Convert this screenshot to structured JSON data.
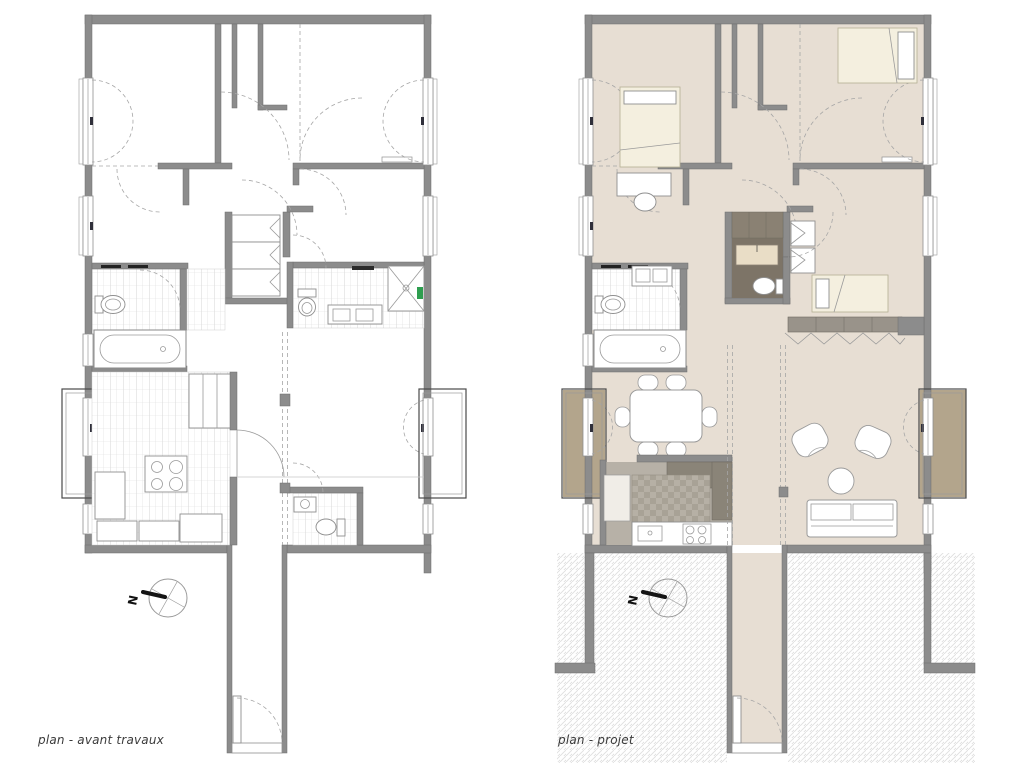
{
  "plans": [
    {
      "id": "avant-travaux",
      "label": "plan - avant travaux",
      "compass_label": "N"
    },
    {
      "id": "projet",
      "label": "plan - projet",
      "compass_label": "N"
    }
  ],
  "palette": {
    "background": "#ffffff",
    "wall": "#8c8c8c",
    "wall_edge": "#6e6e6e",
    "project_floor": "#e7ded3",
    "balcony_floor": "#b3a58c",
    "bathroom_dark_floor": "#7d7467",
    "kitchen_floor": "#b7b1a7",
    "counter_dark": "#8a8478",
    "furniture_cream": "#f4efdf",
    "tile_line": "#d2d2d2",
    "hatch_line": "#dedede",
    "accent_green": "#2e9e4f",
    "dashed_line": "#a6a6a6",
    "text": "#3b3b3b"
  }
}
